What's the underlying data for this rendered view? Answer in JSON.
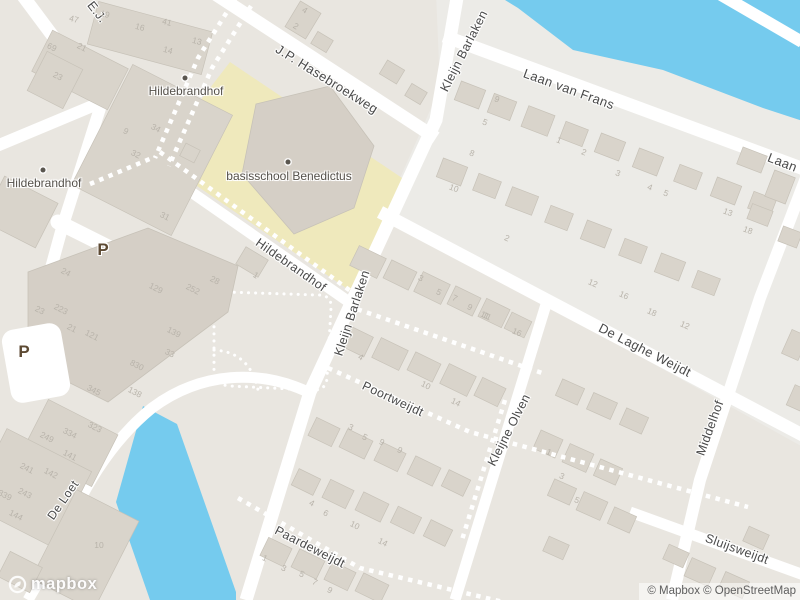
{
  "attribution": {
    "text": "© Mapbox © OpenStreetMap"
  },
  "logo": {
    "text": "mapbox"
  },
  "colors": {
    "land": "#e9e6e0",
    "land_light": "#ecebe7",
    "water": "#75cbee",
    "school_area": "#efe9bc",
    "building": "#d9d4cb",
    "building_outline": "#c7c2b8",
    "road": "#ffffff",
    "street_text": "#4a4a4a",
    "poi_text": "#55514b",
    "parking_text": "#5d4a33",
    "house_number_text": "#b8b3aa"
  },
  "labels": {
    "streets": [
      [
        "E.J.",
        97,
        12,
        52,
        12.5
      ],
      [
        "J.P. Hasebroekweg",
        327,
        79,
        32,
        13
      ],
      [
        "Kleijn Barlaken",
        464,
        51,
        -63,
        12.5
      ],
      [
        "Laan van Frans",
        569,
        89,
        20,
        13
      ],
      [
        "Laan van Frans",
        813,
        174,
        21,
        13
      ],
      [
        "Hildebrandhof",
        291,
        265,
        35,
        12.5
      ],
      [
        "Kleijn Barlaken",
        352,
        313,
        -72,
        12.5
      ],
      [
        "De Laghe Weijdt",
        645,
        350,
        27,
        13
      ],
      [
        "Poortweijdt",
        393,
        399,
        25,
        12.5
      ],
      [
        "Kleijne Olven",
        509,
        430,
        -63,
        12.5
      ],
      [
        "Middelhof",
        710,
        428,
        -70,
        12.5
      ],
      [
        "Paardeweijdt",
        310,
        547,
        27,
        12.5
      ],
      [
        "De Loet",
        63,
        500,
        -55,
        12
      ],
      [
        "Sluijsweijdt",
        737,
        549,
        20,
        12.5
      ]
    ],
    "pois": [
      [
        "Hildebrandhof",
        186,
        91,
        185,
        78
      ],
      [
        "Hildebrandhof",
        44,
        183,
        43,
        170
      ],
      [
        "basisschool Benedictus",
        289,
        176,
        288,
        162
      ]
    ],
    "parking": [
      [
        "P",
        103,
        250
      ],
      [
        "P",
        24,
        352
      ]
    ],
    "house_numbers": [
      [
        "47",
        74,
        19,
        15
      ],
      [
        "19",
        105,
        14,
        15
      ],
      [
        "16",
        140,
        27,
        15
      ],
      [
        "41",
        167,
        22,
        15
      ],
      [
        "13",
        197,
        41,
        15
      ],
      [
        "14",
        168,
        50,
        15
      ],
      [
        "69",
        52,
        47,
        27
      ],
      [
        "21",
        82,
        47,
        27
      ],
      [
        "23",
        58,
        76,
        27
      ],
      [
        "9",
        126,
        131,
        27
      ],
      [
        "34",
        156,
        128,
        27
      ],
      [
        "32",
        136,
        154,
        27
      ],
      [
        "31",
        165,
        216,
        27
      ],
      [
        "4",
        305,
        10,
        31
      ],
      [
        "2",
        296,
        26,
        31
      ],
      [
        "24",
        66,
        272,
        27
      ],
      [
        "129",
        156,
        288,
        27
      ],
      [
        "252",
        193,
        289,
        27
      ],
      [
        "28",
        215,
        280,
        27
      ],
      [
        "23",
        40,
        310,
        27
      ],
      [
        "223",
        61,
        309,
        27
      ],
      [
        "21",
        72,
        328,
        27
      ],
      [
        "121",
        92,
        335,
        27
      ],
      [
        "139",
        174,
        332,
        27
      ],
      [
        "33",
        170,
        353,
        27
      ],
      [
        "830",
        137,
        365,
        27
      ],
      [
        "345",
        94,
        390,
        27
      ],
      [
        "138",
        135,
        392,
        27
      ],
      [
        "249",
        47,
        437,
        27
      ],
      [
        "334",
        70,
        433,
        27
      ],
      [
        "323",
        95,
        427,
        27
      ],
      [
        "141",
        70,
        455,
        27
      ],
      [
        "241",
        27,
        468,
        27
      ],
      [
        "142",
        51,
        473,
        27
      ],
      [
        "339",
        5,
        495,
        27
      ],
      [
        "243",
        25,
        493,
        27
      ],
      [
        "144",
        16,
        515,
        27
      ],
      [
        "10",
        99,
        545,
        0
      ],
      [
        "8",
        472,
        153,
        21
      ],
      [
        "9",
        497,
        99,
        21
      ],
      [
        "5",
        485,
        122,
        21
      ],
      [
        "1",
        559,
        140,
        21
      ],
      [
        "2",
        584,
        152,
        21
      ],
      [
        "3",
        618,
        173,
        21
      ],
      [
        "10",
        454,
        188,
        21
      ],
      [
        "4",
        650,
        187,
        21
      ],
      [
        "5",
        666,
        193,
        21
      ],
      [
        "13",
        728,
        212,
        21
      ],
      [
        "18",
        748,
        230,
        21
      ],
      [
        "12",
        593,
        283,
        24
      ],
      [
        "16",
        624,
        295,
        24
      ],
      [
        "18",
        652,
        312,
        24
      ],
      [
        "12",
        685,
        325,
        24
      ],
      [
        "11",
        485,
        315,
        24
      ],
      [
        "16",
        517,
        332,
        24
      ],
      [
        "1",
        256,
        275,
        31
      ],
      [
        "2",
        507,
        238,
        24
      ],
      [
        "3",
        421,
        278,
        26
      ],
      [
        "5",
        439,
        292,
        26
      ],
      [
        "7",
        455,
        298,
        26
      ],
      [
        "9",
        470,
        307,
        26
      ],
      [
        "11",
        487,
        316,
        26
      ],
      [
        "4",
        361,
        357,
        26
      ],
      [
        "10",
        426,
        385,
        26
      ],
      [
        "14",
        456,
        402,
        26
      ],
      [
        "3",
        351,
        427,
        26
      ],
      [
        "5",
        365,
        437,
        26
      ],
      [
        "9",
        382,
        442,
        26
      ],
      [
        "9",
        400,
        450,
        26
      ],
      [
        "4",
        312,
        503,
        26
      ],
      [
        "6",
        326,
        513,
        26
      ],
      [
        "10",
        355,
        525,
        26
      ],
      [
        "14",
        383,
        542,
        26
      ],
      [
        "1",
        265,
        558,
        26
      ],
      [
        "3",
        284,
        568,
        26
      ],
      [
        "5",
        302,
        574,
        26
      ],
      [
        "7",
        315,
        582,
        26
      ],
      [
        "9",
        330,
        590,
        26
      ],
      [
        "1",
        549,
        452,
        24
      ],
      [
        "3",
        562,
        476,
        24
      ],
      [
        "5",
        577,
        500,
        24
      ]
    ]
  }
}
